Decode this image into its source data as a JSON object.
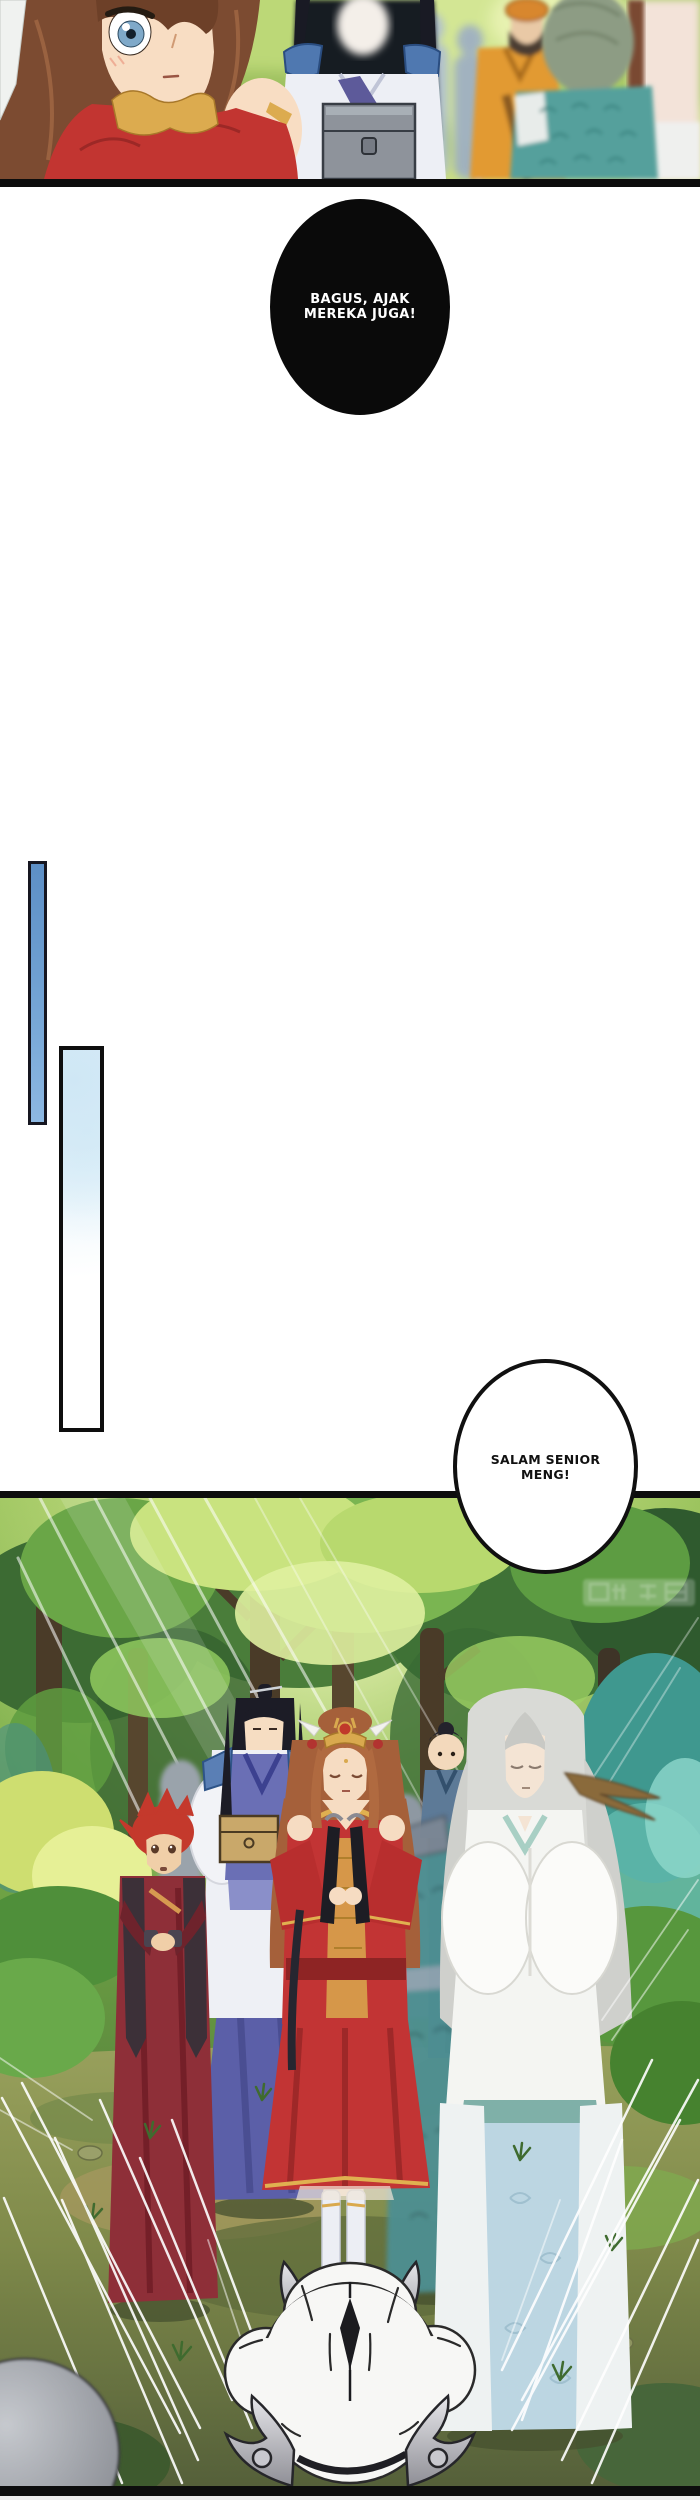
{
  "page": {
    "width": 700,
    "height": 2500,
    "background": "#ffffff",
    "type": "translated-manhua-page",
    "language": "Indonesian"
  },
  "panel_top": {
    "scene": "blurred close-up of girl in red with brown hair, men in blue, orange and teal robes among yellow-green foliage",
    "border_color": "#0d0d0d"
  },
  "bubble_shout": {
    "lines": [
      "BAGUS, AJAK",
      "MEREKA JUGA!"
    ],
    "fill": "#0a0a0a",
    "text_color": "#ffffff"
  },
  "bubble_greeting": {
    "lines": [
      "SALAM SENIOR",
      "MENG!"
    ],
    "fill": "#ffffff",
    "text_color": "#111111",
    "border_color": "#101010"
  },
  "transition_bars": {
    "small": {
      "fill_top": "#5d8fc6",
      "fill_bottom": "#8db8e2",
      "border": "#161620"
    },
    "large": {
      "fill_top": "#d9ecf7",
      "fill_bottom": "#ffffff",
      "border": "#0e0e0e"
    }
  },
  "panel_forest": {
    "scene": "group of robed cultivators on a sunlit forest path facing a white horned beast seen from behind",
    "border_color": "#0d0d0d",
    "watermark": {
      "present": true,
      "text_legible": false
    },
    "palette": {
      "foliage_bright": "#cfe87a",
      "foliage_mid": "#74a846",
      "foliage_dark": "#2f5d33",
      "teal_foliage": "#4aa89e",
      "ground": "#8f9152",
      "girl_dress_red": "#c23434",
      "beast_white": "#f7f7f5"
    }
  }
}
